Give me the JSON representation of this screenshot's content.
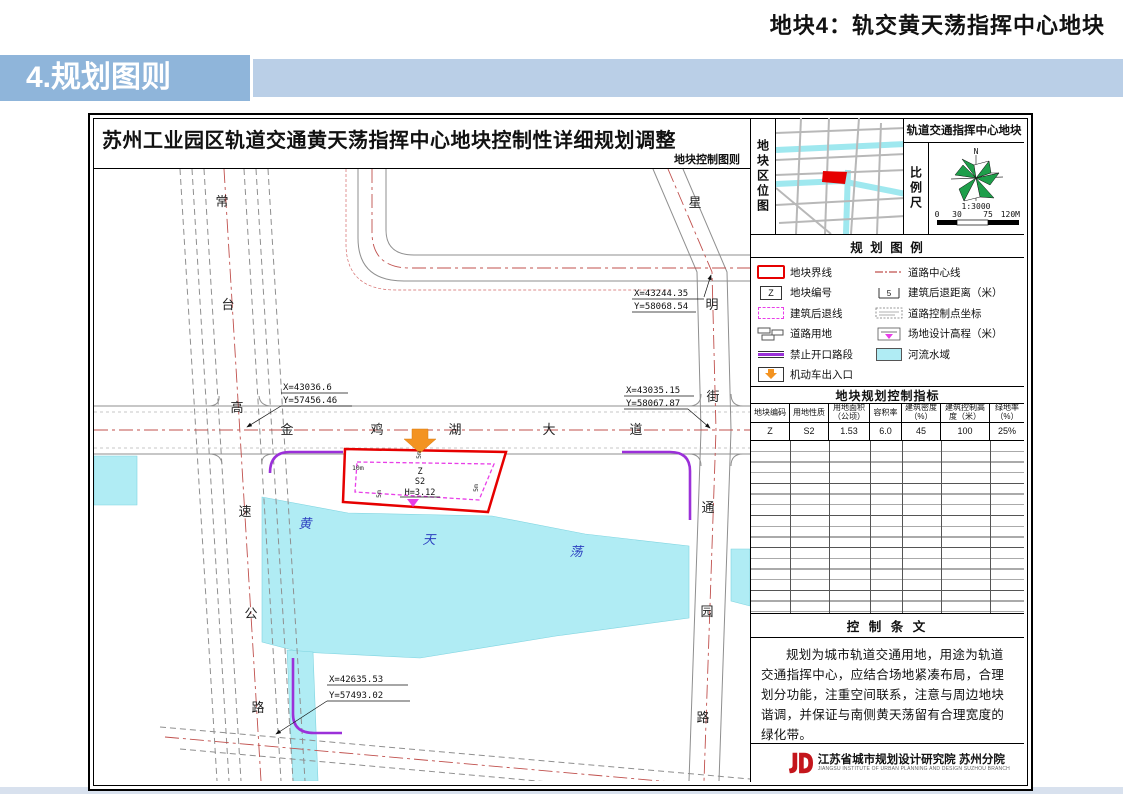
{
  "header": {
    "page_title": "地块4：轨交黄天荡指挥中心地块",
    "section_banner": "4.规划图则"
  },
  "sheet": {
    "title": "苏州工业园区轨道交通黄天荡指挥中心地块控制性详细规划调整",
    "subtitle": "地块控制图则"
  },
  "map": {
    "road_changtai": "常台高速公路",
    "road_jinjihu": "金鸡湖大道",
    "road_xingming": "星明街",
    "road_tongyuan": "通园路",
    "water_name": "黄天荡",
    "coords": [
      {
        "x": "X=43244.35",
        "y": "Y=58068.54"
      },
      {
        "x": "X=43035.15",
        "y": "Y=58067.87"
      },
      {
        "x": "X=43036.6",
        "y": "Y=57456.46"
      },
      {
        "x": "X=42635.53",
        "y": "Y=57493.02"
      }
    ],
    "parcel": {
      "code": "Z",
      "land_use": "S2",
      "elevation": "H=3.12",
      "setback_left": "10m",
      "setback_top": "5m",
      "setback_right": "5m",
      "setback_bottom": "5m"
    }
  },
  "panel": {
    "location_label": "地块区位图",
    "location_title": "轨道交通指挥中心地块",
    "scale_label": "比例尺",
    "compass_n": "N",
    "scale_ratio": "1:3000",
    "scale_ticks": [
      "0",
      "30",
      "75",
      "120M"
    ],
    "legend": {
      "title": "规 划 图 例",
      "z_sample": "Z",
      "setback_sample": "5",
      "left": [
        "地块界线",
        "地块编号",
        "建筑后退线",
        "道路用地",
        "禁止开口路段",
        "机动车出入口"
      ],
      "right": [
        "道路中心线",
        "建筑后退距离（米）",
        "道路控制点坐标",
        "场地设计高程（米）",
        "河流水域"
      ]
    },
    "indicators": {
      "title": "地块规划控制指标",
      "headers": [
        "地块编码",
        "用地性质",
        "用地面积（公顷）",
        "容积率",
        "建筑密度（%）",
        "建筑控制高度（米）",
        "绿地率（%）"
      ],
      "row": [
        "Z",
        "S2",
        "1.53",
        "6.0",
        "45",
        "100",
        "25%"
      ]
    },
    "provisions": {
      "title": "控 制 条 文",
      "body": "规划为城市轨道交通用地，用途为轨道交通指挥中心，应结合场地紧凑布局，合理划分功能，注重空间联系，注意与周边地块谐调，并保证与南侧黄天荡留有合理宽度的绿化带。"
    },
    "publisher": {
      "name": "江苏省城市规划设计研究院 苏州分院",
      "name_en": "JIANGSU INSTITUTE OF URBAN PLANNING AND DESIGN  SUZHOU BRANCH"
    }
  },
  "colors": {
    "parcel_outline": "#e60000",
    "building_setback": "#e83ee8",
    "no_access_line": "#9b30d9",
    "entrance_arrow": "#f39321",
    "water": "#b0ecf4",
    "road_centerline": "#c0504d",
    "banner_left": "#8fb5da",
    "banner_right": "#bacfe7"
  }
}
